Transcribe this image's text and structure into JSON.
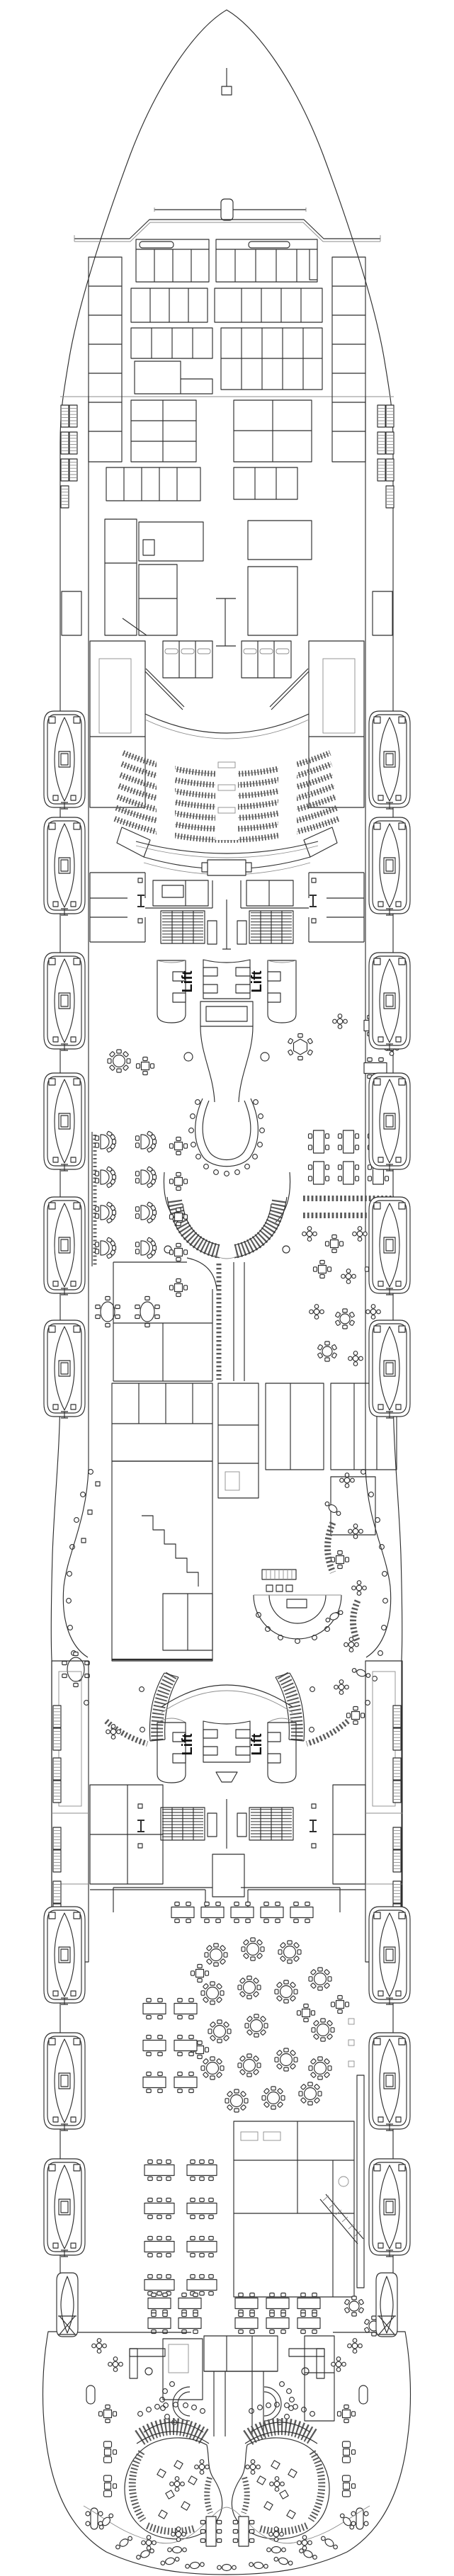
{
  "page": {
    "title": "Cruise ship deck plan"
  },
  "labels": {
    "lift": "Lift"
  },
  "colors": {
    "background": "#ffffff",
    "wall": "#2f2f2f",
    "light": "#8c8c8c",
    "seat": "#5a5a5a",
    "text": "#111111"
  }
}
